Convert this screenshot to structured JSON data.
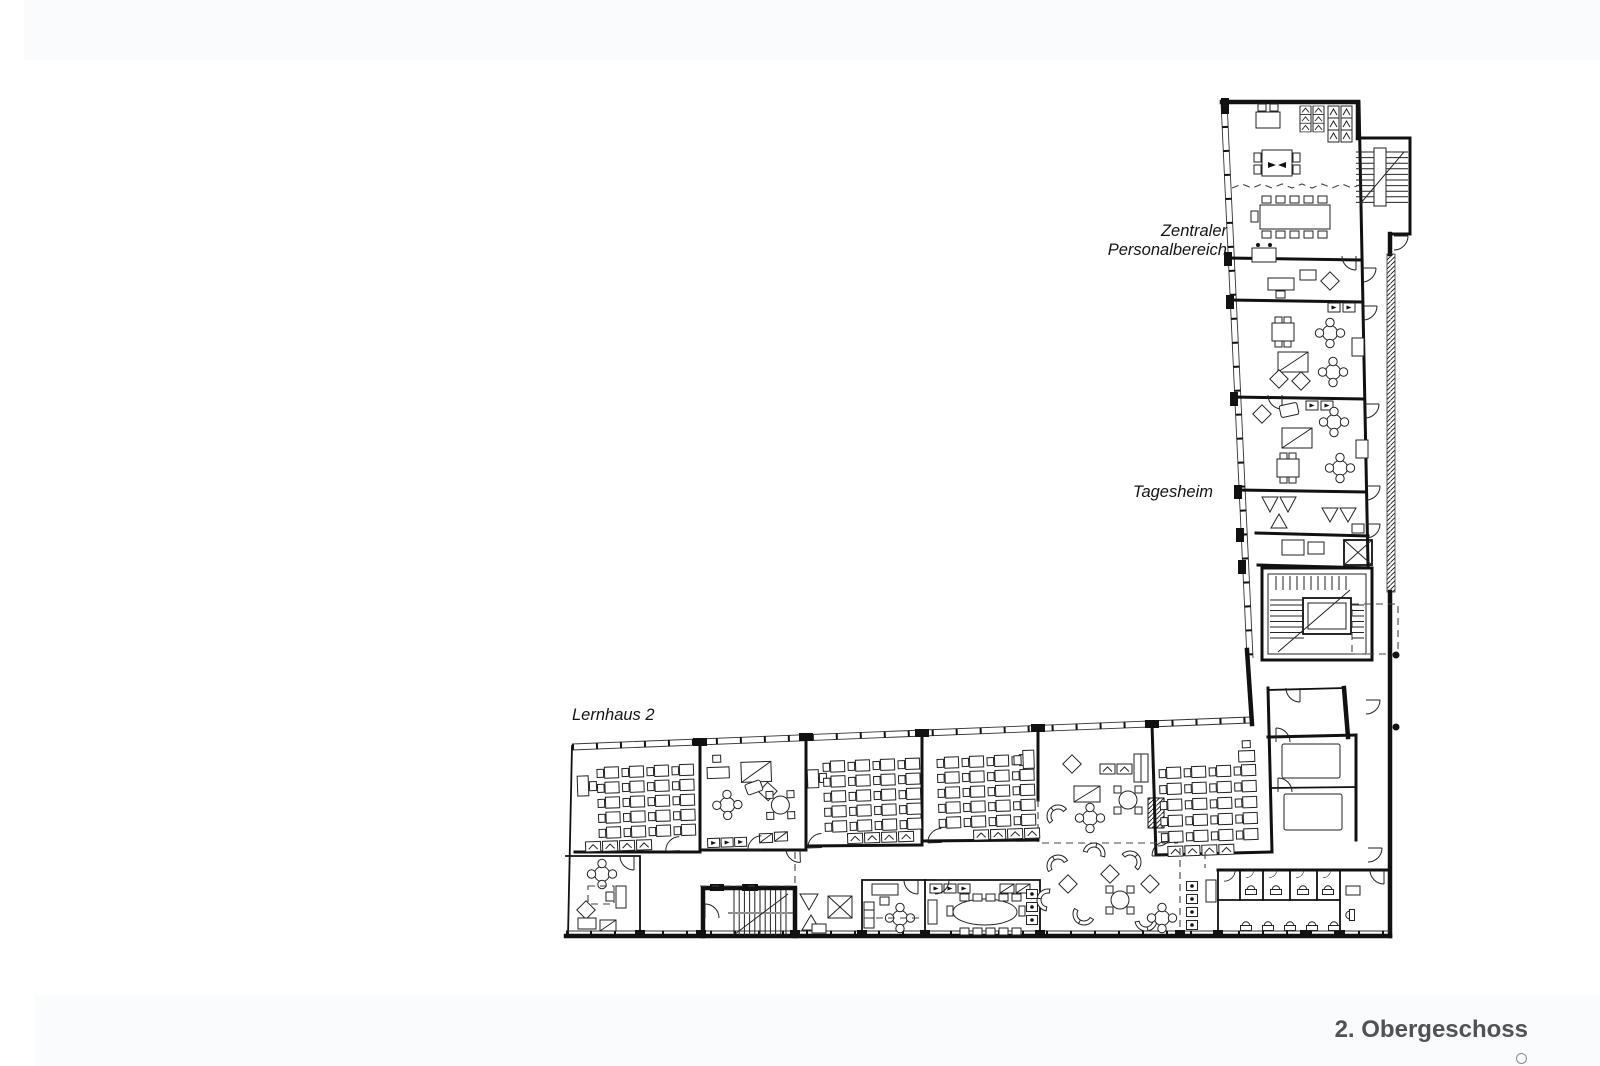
{
  "page": {
    "background": "#ffffff",
    "band_color": "#fafbfd"
  },
  "plan": {
    "type": "architectural-floor-plan",
    "title": "2. Obergeschoss",
    "line_color": "#111111",
    "title_color": "#515156",
    "areas": [
      {
        "id": "zentraler-personalbereich",
        "label_line1": "Zentraler",
        "label_line2": "Personalbereich"
      },
      {
        "id": "tagesheim",
        "label": "Tagesheim"
      },
      {
        "id": "lernhaus-2",
        "label": "Lernhaus 2"
      }
    ]
  }
}
